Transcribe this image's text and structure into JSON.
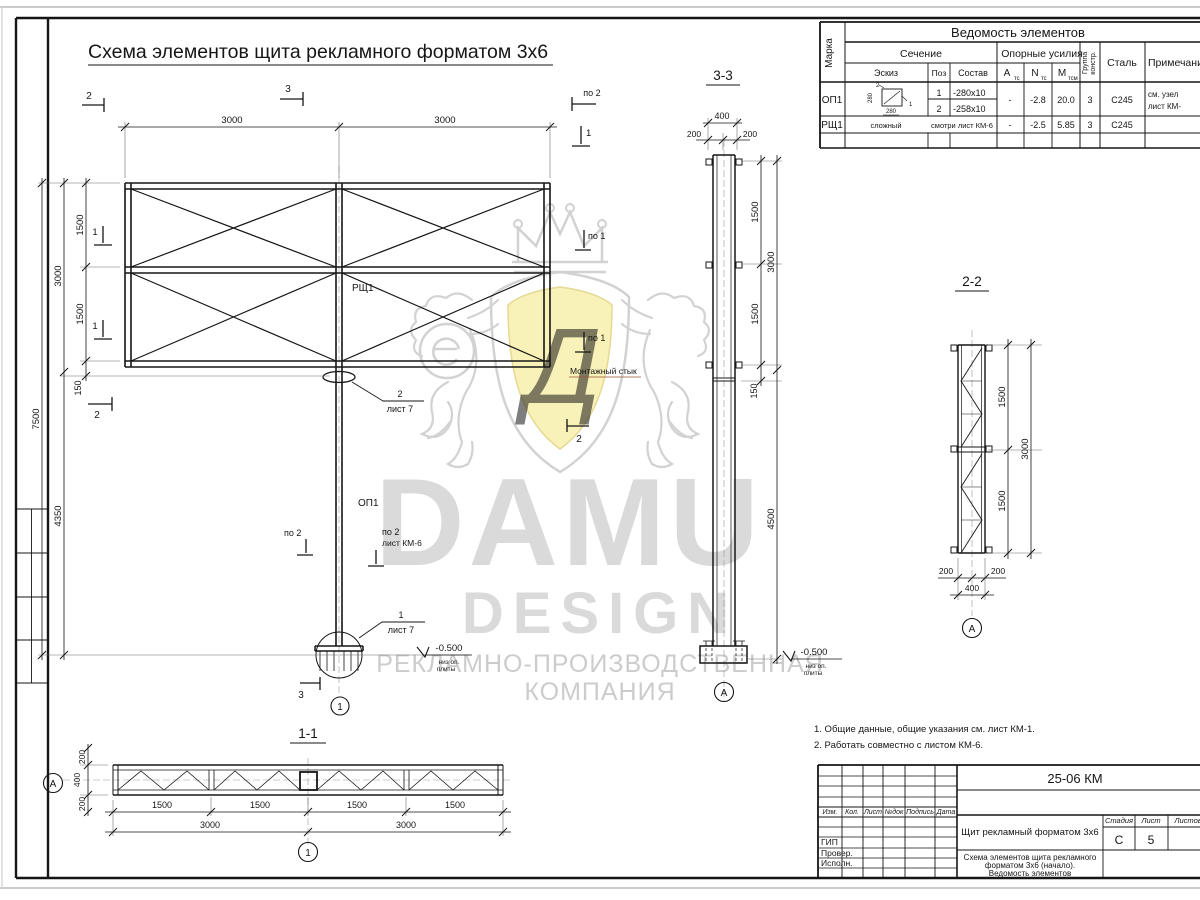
{
  "title": "Схема элементов щита рекламного форматом 3х6",
  "watermark": {
    "damu": "DAMU",
    "design": "DESIGN",
    "line1": "РЕКЛАМНО-ПРОИЗВОДСТВЕННАЯ",
    "line2": "КОМПАНИЯ",
    "monogram": "Д"
  },
  "sections": {
    "s11": "1-1",
    "s22": "2-2",
    "s33": "3-3"
  },
  "grid": {
    "a": "А",
    "axis1": "1"
  },
  "markers": {
    "m1": "1",
    "m2": "2",
    "m3": "3",
    "po1": "по 1",
    "po2": "по 2"
  },
  "labels": {
    "op1": "ОП1",
    "rsh1": "РЩ1",
    "montage": "Монтажный стык",
    "level": "-0.500",
    "level_note1": "низ оп.",
    "level_note2": "плиты",
    "c1": "1",
    "c2": "2",
    "sheet7": "лист 7",
    "sheetKM6": "лист КМ-6"
  },
  "dims": {
    "v150": "150",
    "v200": "200",
    "v400": "400",
    "v1500": "1500",
    "v3000": "3000",
    "v4350": "4350",
    "v4500": "4500",
    "v7500": "7500"
  },
  "elements_table": {
    "title": "Ведомость элементов",
    "marka": "Марка",
    "sechenie": "Сечение",
    "eskiz": "Эскиз",
    "poz": "Поз",
    "sostav": "Состав",
    "oporn": "Опорные усилия",
    "a": "А",
    "n": "N",
    "m": "М",
    "ts": "тс",
    "tsm": "тсм",
    "gruppa1": "Группа",
    "gruppa2": "констр.",
    "stal": "Сталь",
    "prim": "Примечание",
    "rows": [
      {
        "marka": "ОП1",
        "sk280": "280",
        "sk1": "1",
        "sk2": "2",
        "poz1": "1",
        "sostav1": "-280х10",
        "poz2": "2",
        "sostav2": "-258х10",
        "a": "-",
        "n": "-2.8",
        "m": "20.0",
        "gr": "3",
        "stal": "С245",
        "prim1": "см. узел",
        "prim2": "лист КМ-"
      },
      {
        "marka": "РЩ1",
        "eskiz": "сложный",
        "sostav": "смотри лист КМ-6",
        "a": "-",
        "n": "-2.5",
        "m": "5.85",
        "gr": "3",
        "stal": "С245"
      }
    ]
  },
  "notes": {
    "n1": "1. Общие данные, общие указания см. лист КМ-1.",
    "n2": "2. Работать совместно с листом КМ-6."
  },
  "titleblock": {
    "code": "25-06 КМ",
    "izm": "Изм.",
    "kol": "Кол.",
    "list": "Лист",
    "ndok": "№док",
    "podpis": "Подпись",
    "data": "Дата",
    "gip": "ГИП",
    "prover": "Провер.",
    "ispoln": "Исполн.",
    "object": "Щит рекламный форматом 3х6",
    "desc1": "Схема элементов щита рекламного",
    "desc2": "форматом 3х6 (начало).",
    "desc3": "Ведомость элементов",
    "stadia": "Стадия",
    "listov": "Листов",
    "stadia_val": "С",
    "list_val": "5"
  }
}
